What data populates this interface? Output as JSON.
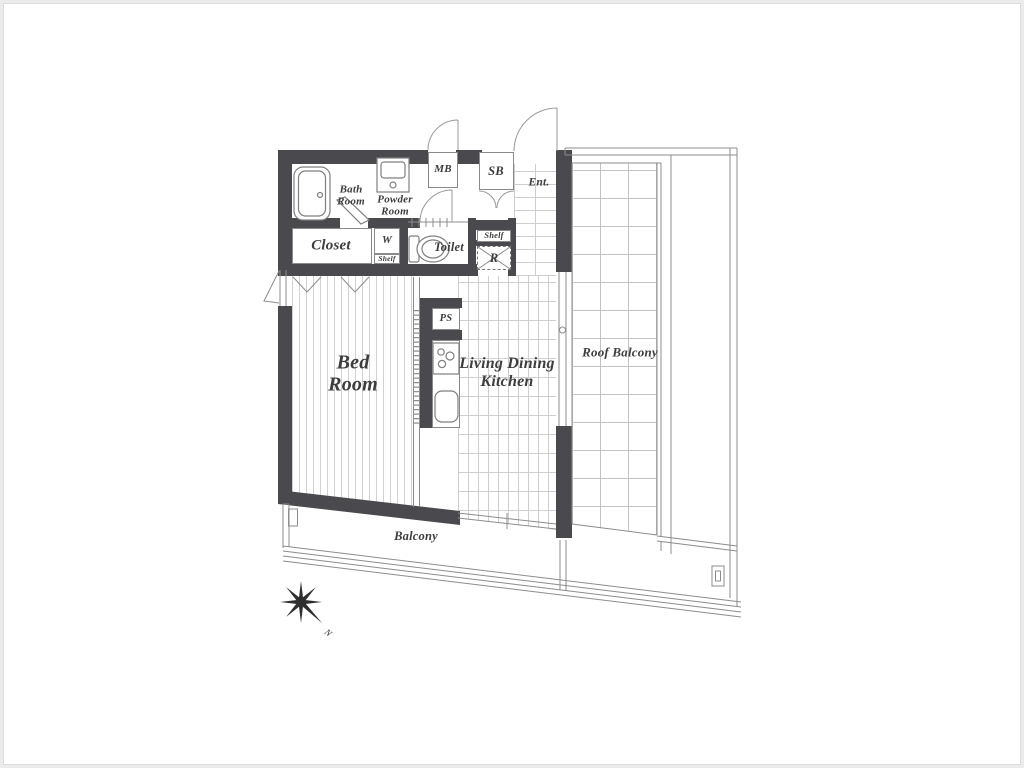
{
  "labels": {
    "bath_room": "Bath\nRoom",
    "powder_room": "Powder\nRoom",
    "mb": "MB",
    "sb": "SB",
    "ent": "Ent.",
    "closet": "Closet",
    "w": "W",
    "shelf_w": "Shelf",
    "toilet": "Toilet",
    "shelf_r": "Shelf",
    "r": "R",
    "ps": "PS",
    "bed_room": "Bed\nRoom",
    "ldk": "Living Dining\nKitchen",
    "roof_balcony": "Roof Balcony",
    "balcony": "Balcony"
  },
  "compass": {
    "direction": "N"
  },
  "colors": {
    "wall": "#4a4a4e",
    "line": "#8c8c8c",
    "text": "#3d3d3d"
  }
}
